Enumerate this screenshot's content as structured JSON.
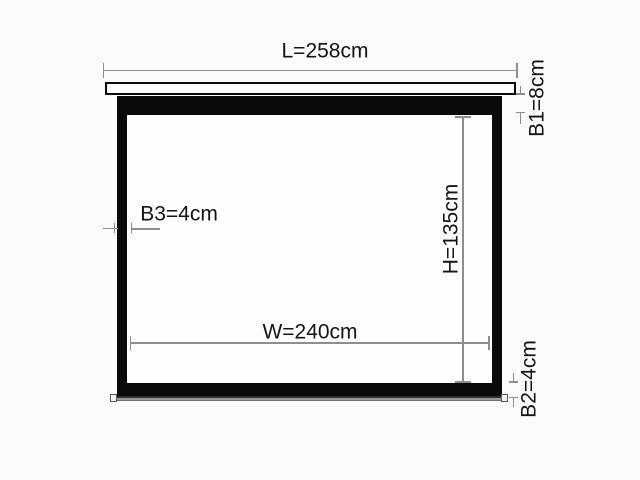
{
  "diagram": {
    "title": "projection-screen-dimension-diagram",
    "dimensions": [
      {
        "id": "L",
        "label": "L=258cm",
        "value": 258,
        "unit": "cm"
      },
      {
        "id": "B1",
        "label": "B1=8cm",
        "value": 8,
        "unit": "cm"
      },
      {
        "id": "B3",
        "label": "B3=4cm",
        "value": 4,
        "unit": "cm"
      },
      {
        "id": "H",
        "label": "H=135cm",
        "value": 135,
        "unit": "cm"
      },
      {
        "id": "W",
        "label": "W=240cm",
        "value": 240,
        "unit": "cm"
      },
      {
        "id": "B2",
        "label": "B2=4cm",
        "value": 4,
        "unit": "cm"
      }
    ],
    "colors": {
      "background": "#fbfbfb",
      "frame": "#0a0a0a",
      "screen_surface": "#fefefe",
      "dimension_line": "#8e8e8e",
      "label_text": "#141414",
      "weight_bar": "#9a9a9a"
    }
  }
}
